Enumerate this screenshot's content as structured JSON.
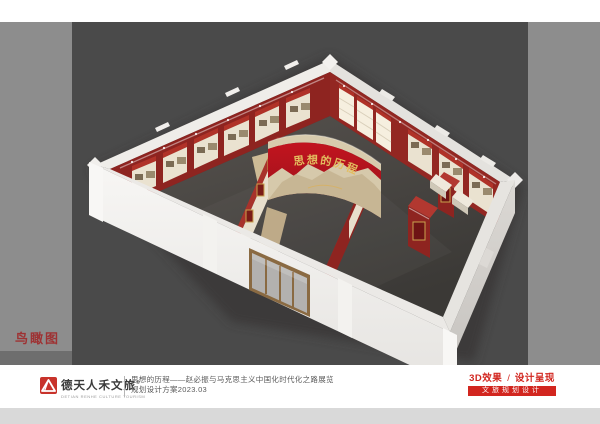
{
  "frame": {
    "view_label": "鸟瞰图"
  },
  "render": {
    "feature_wall_title": "思想的历程",
    "description": "3D bird's-eye rendering of exhibition hall with red display walls, cream exhibit panels, curved stone feature wall and white perimeter walls"
  },
  "footer": {
    "logo": {
      "name": "德天人禾文旅",
      "reg_mark": "®",
      "subtitle": "DETIAN RENHE CULTURE TOURISM"
    },
    "project_line1": "思想的历程——赵必振与马克思主义中国化时代化之路展览",
    "project_line2": "规划设计方案2023.03",
    "output_type": "3D效果",
    "separator": "/",
    "output_stage": "设计呈现",
    "banner": "文旅规划设计"
  },
  "colors": {
    "brand_red": "#d2261f",
    "view_label_red": "#9e3233",
    "margin_gray": "#8d8d8d",
    "canvas_gray": "#4a4a4a",
    "bottom_strip_gray": "#d9d9d9",
    "exhibit_wall_red": "#8e2420",
    "panel_cream": "#eae2d0",
    "gold": "#e3bd5f"
  }
}
